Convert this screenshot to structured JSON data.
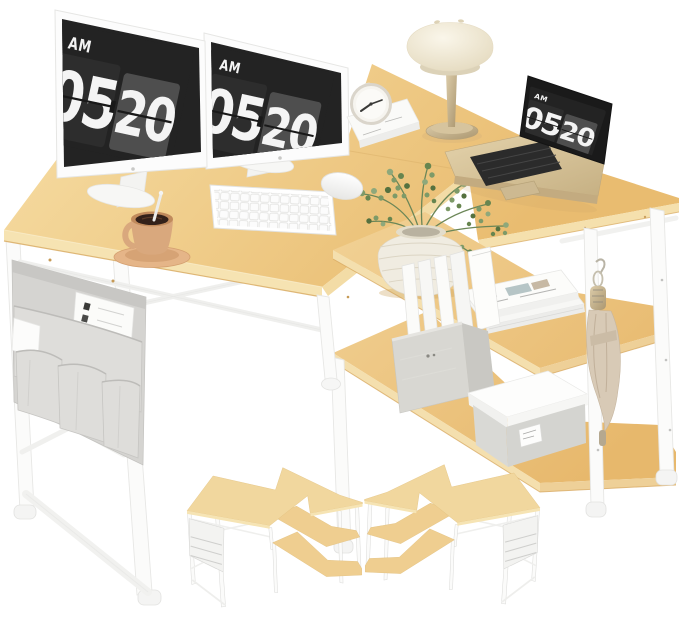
{
  "product_image": {
    "clock": {
      "meridiem": "AM",
      "hour": "05",
      "minute": "20"
    },
    "colors": {
      "background": "#ffffff",
      "desk_wood": "#e9bc70",
      "desk_wood_light": "#f4d89c",
      "desk_edge": "#f6e3b2",
      "frame_white": "#fbfbfa",
      "frame_line": "#e6e6e4",
      "screen_dark": "#232323",
      "flip_card": "#4e4e4e",
      "digit_white": "#f4f4f4",
      "bezel_white": "#fcfcfc",
      "bag_gray": "#d5d4d1",
      "bag_pocket": "#deddda",
      "mug_tan": "#d9a87d",
      "coffee_brown": "#33211a",
      "saucer_tan": "#e5b588",
      "lamp_cream": "#f1e9d7",
      "metal_champagne": "#c8b28c",
      "plant_green": "#7d9a68",
      "vase_white": "#f0ece1",
      "fabric_cube": "#d8d7d2",
      "box_gray": "#d9d9d5",
      "umbrella_beige": "#d8cab6",
      "laptop_gold": "#d6c29a"
    },
    "items": [
      "dual-monitors-with-flip-clock",
      "wireless-keyboard",
      "mouse",
      "coffee-mug",
      "mushroom-table-lamp",
      "alarm-clock-on-book",
      "laptop-with-flip-clock",
      "l-shaped-desk",
      "reversible-storage-shelves",
      "plant-vase",
      "book-stack",
      "fabric-storage-cube",
      "storage-box",
      "folded-umbrella",
      "side-storage-bag",
      "configuration-thumbnail-left",
      "configuration-thumbnail-right"
    ]
  }
}
